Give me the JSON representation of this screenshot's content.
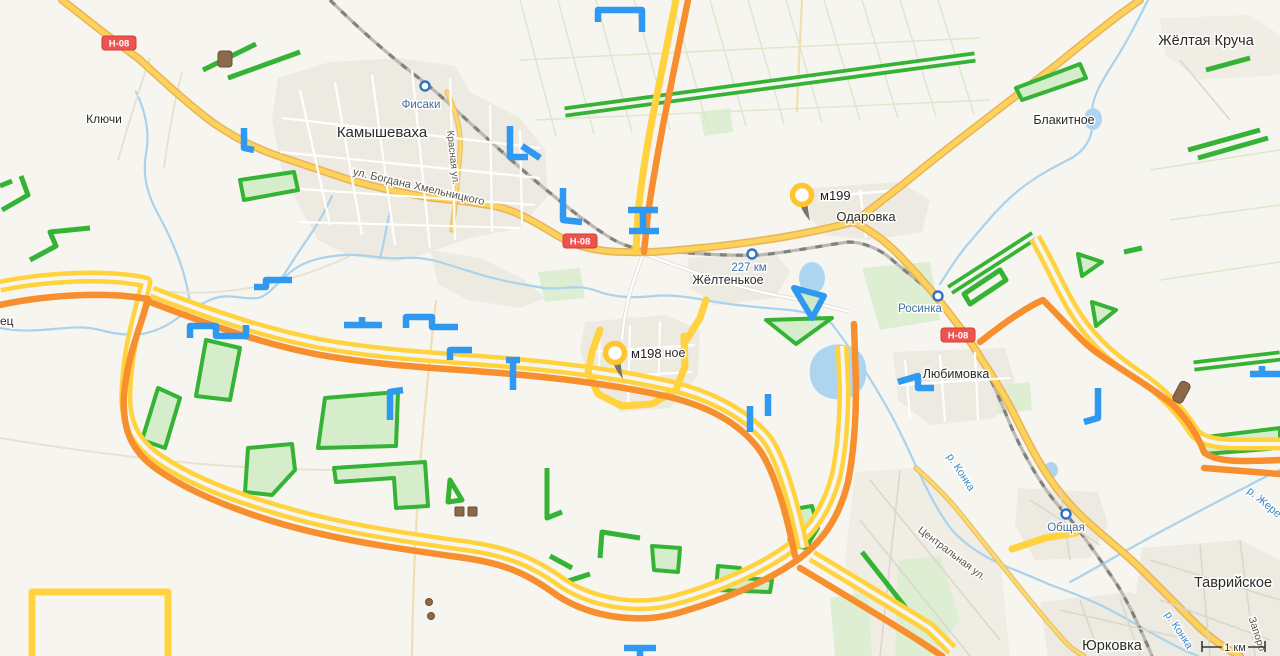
{
  "map": {
    "scale": {
      "label": "1 км"
    },
    "badges": [
      {
        "t": "Н-08",
        "x": 119,
        "y": 43
      },
      {
        "t": "Н-08",
        "x": 580,
        "y": 241
      },
      {
        "t": "Н-08",
        "x": 958,
        "y": 335
      }
    ],
    "markers": [
      {
        "label": "м199",
        "x": 802,
        "y": 195,
        "lx": 820,
        "ly": 200
      },
      {
        "label": "м198",
        "x": 615,
        "y": 353,
        "lx": 631,
        "ly": 358
      }
    ],
    "stations": [
      {
        "t": "Фисаки",
        "x": 425,
        "y": 86,
        "tx": 421,
        "ty": 108
      },
      {
        "t": "227 км",
        "x": 752,
        "y": 254,
        "tx": 749,
        "ty": 271
      },
      {
        "t": "Росинка",
        "x": 938,
        "y": 296,
        "tx": 920,
        "ty": 312
      },
      {
        "t": "Общая",
        "x": 1066,
        "y": 514,
        "tx": 1066,
        "ty": 531
      }
    ],
    "labels": [
      {
        "t": "Ключи",
        "x": 104,
        "y": 123,
        "cls": "town",
        "s": 12
      },
      {
        "t": "Камышеваха",
        "x": 382,
        "y": 137,
        "cls": "town",
        "s": 15
      },
      {
        "t": "Одаровка",
        "x": 866,
        "y": 221,
        "cls": "town",
        "s": 13
      },
      {
        "t": "Жёлтенькое",
        "x": 728,
        "y": 284,
        "cls": "town",
        "s": 12.5
      },
      {
        "t": "Любимовка",
        "x": 956,
        "y": 378,
        "cls": "town",
        "s": 12.5
      },
      {
        "t": "Блакитное",
        "x": 1064,
        "y": 124,
        "cls": "town",
        "s": 12.5
      },
      {
        "t": "Жёлтая Круча",
        "x": 1206,
        "y": 45,
        "cls": "town",
        "s": 14.5
      },
      {
        "t": "Таврийское",
        "x": 1233,
        "y": 587,
        "cls": "town",
        "s": 14.5
      },
      {
        "t": "Юрковка",
        "x": 1112,
        "y": 650,
        "cls": "town",
        "s": 14.5
      },
      {
        "t": "ное",
        "x": 675,
        "y": 357,
        "cls": "town",
        "s": 12.5
      },
      {
        "t": "ец",
        "x": 0,
        "y": 325,
        "cls": "town",
        "s": 12,
        "a": "start"
      },
      {
        "t": "ул. Богдана Хмельницкого",
        "x": 418,
        "y": 190,
        "cls": "street",
        "s": 11,
        "r": 13
      },
      {
        "t": "Красная ул.",
        "x": 450,
        "y": 158,
        "cls": "street",
        "s": 10,
        "r": 84
      },
      {
        "t": "Центральная ул.",
        "x": 950,
        "y": 556,
        "cls": "street",
        "s": 10.5,
        "r": 37
      },
      {
        "t": "Запоро",
        "x": 1254,
        "y": 635,
        "cls": "street",
        "s": 10.5,
        "r": 72
      },
      {
        "t": "р. Конка",
        "x": 958,
        "y": 474,
        "cls": "river",
        "s": 11,
        "r": 57
      },
      {
        "t": "р. Конка",
        "x": 1176,
        "y": 632,
        "cls": "river",
        "s": 11,
        "r": 57
      },
      {
        "t": "р. Жере",
        "x": 1262,
        "y": 505,
        "cls": "river",
        "s": 11,
        "r": 40
      }
    ],
    "colors": {
      "land": "#f6f5f0",
      "urban": "#edeae1",
      "water": "#aed5ef",
      "road_yellow": "#fdd25b",
      "railway": "#83817c",
      "annotation_green": "#35b335",
      "annotation_blue": "#2f98f0",
      "annotation_yellow": "#ffd23e",
      "annotation_orange": "#f78f2e",
      "badge_red": "#ef5350",
      "pin_yellow": "#ffc52e",
      "station_blue": "#2e73c5"
    }
  }
}
